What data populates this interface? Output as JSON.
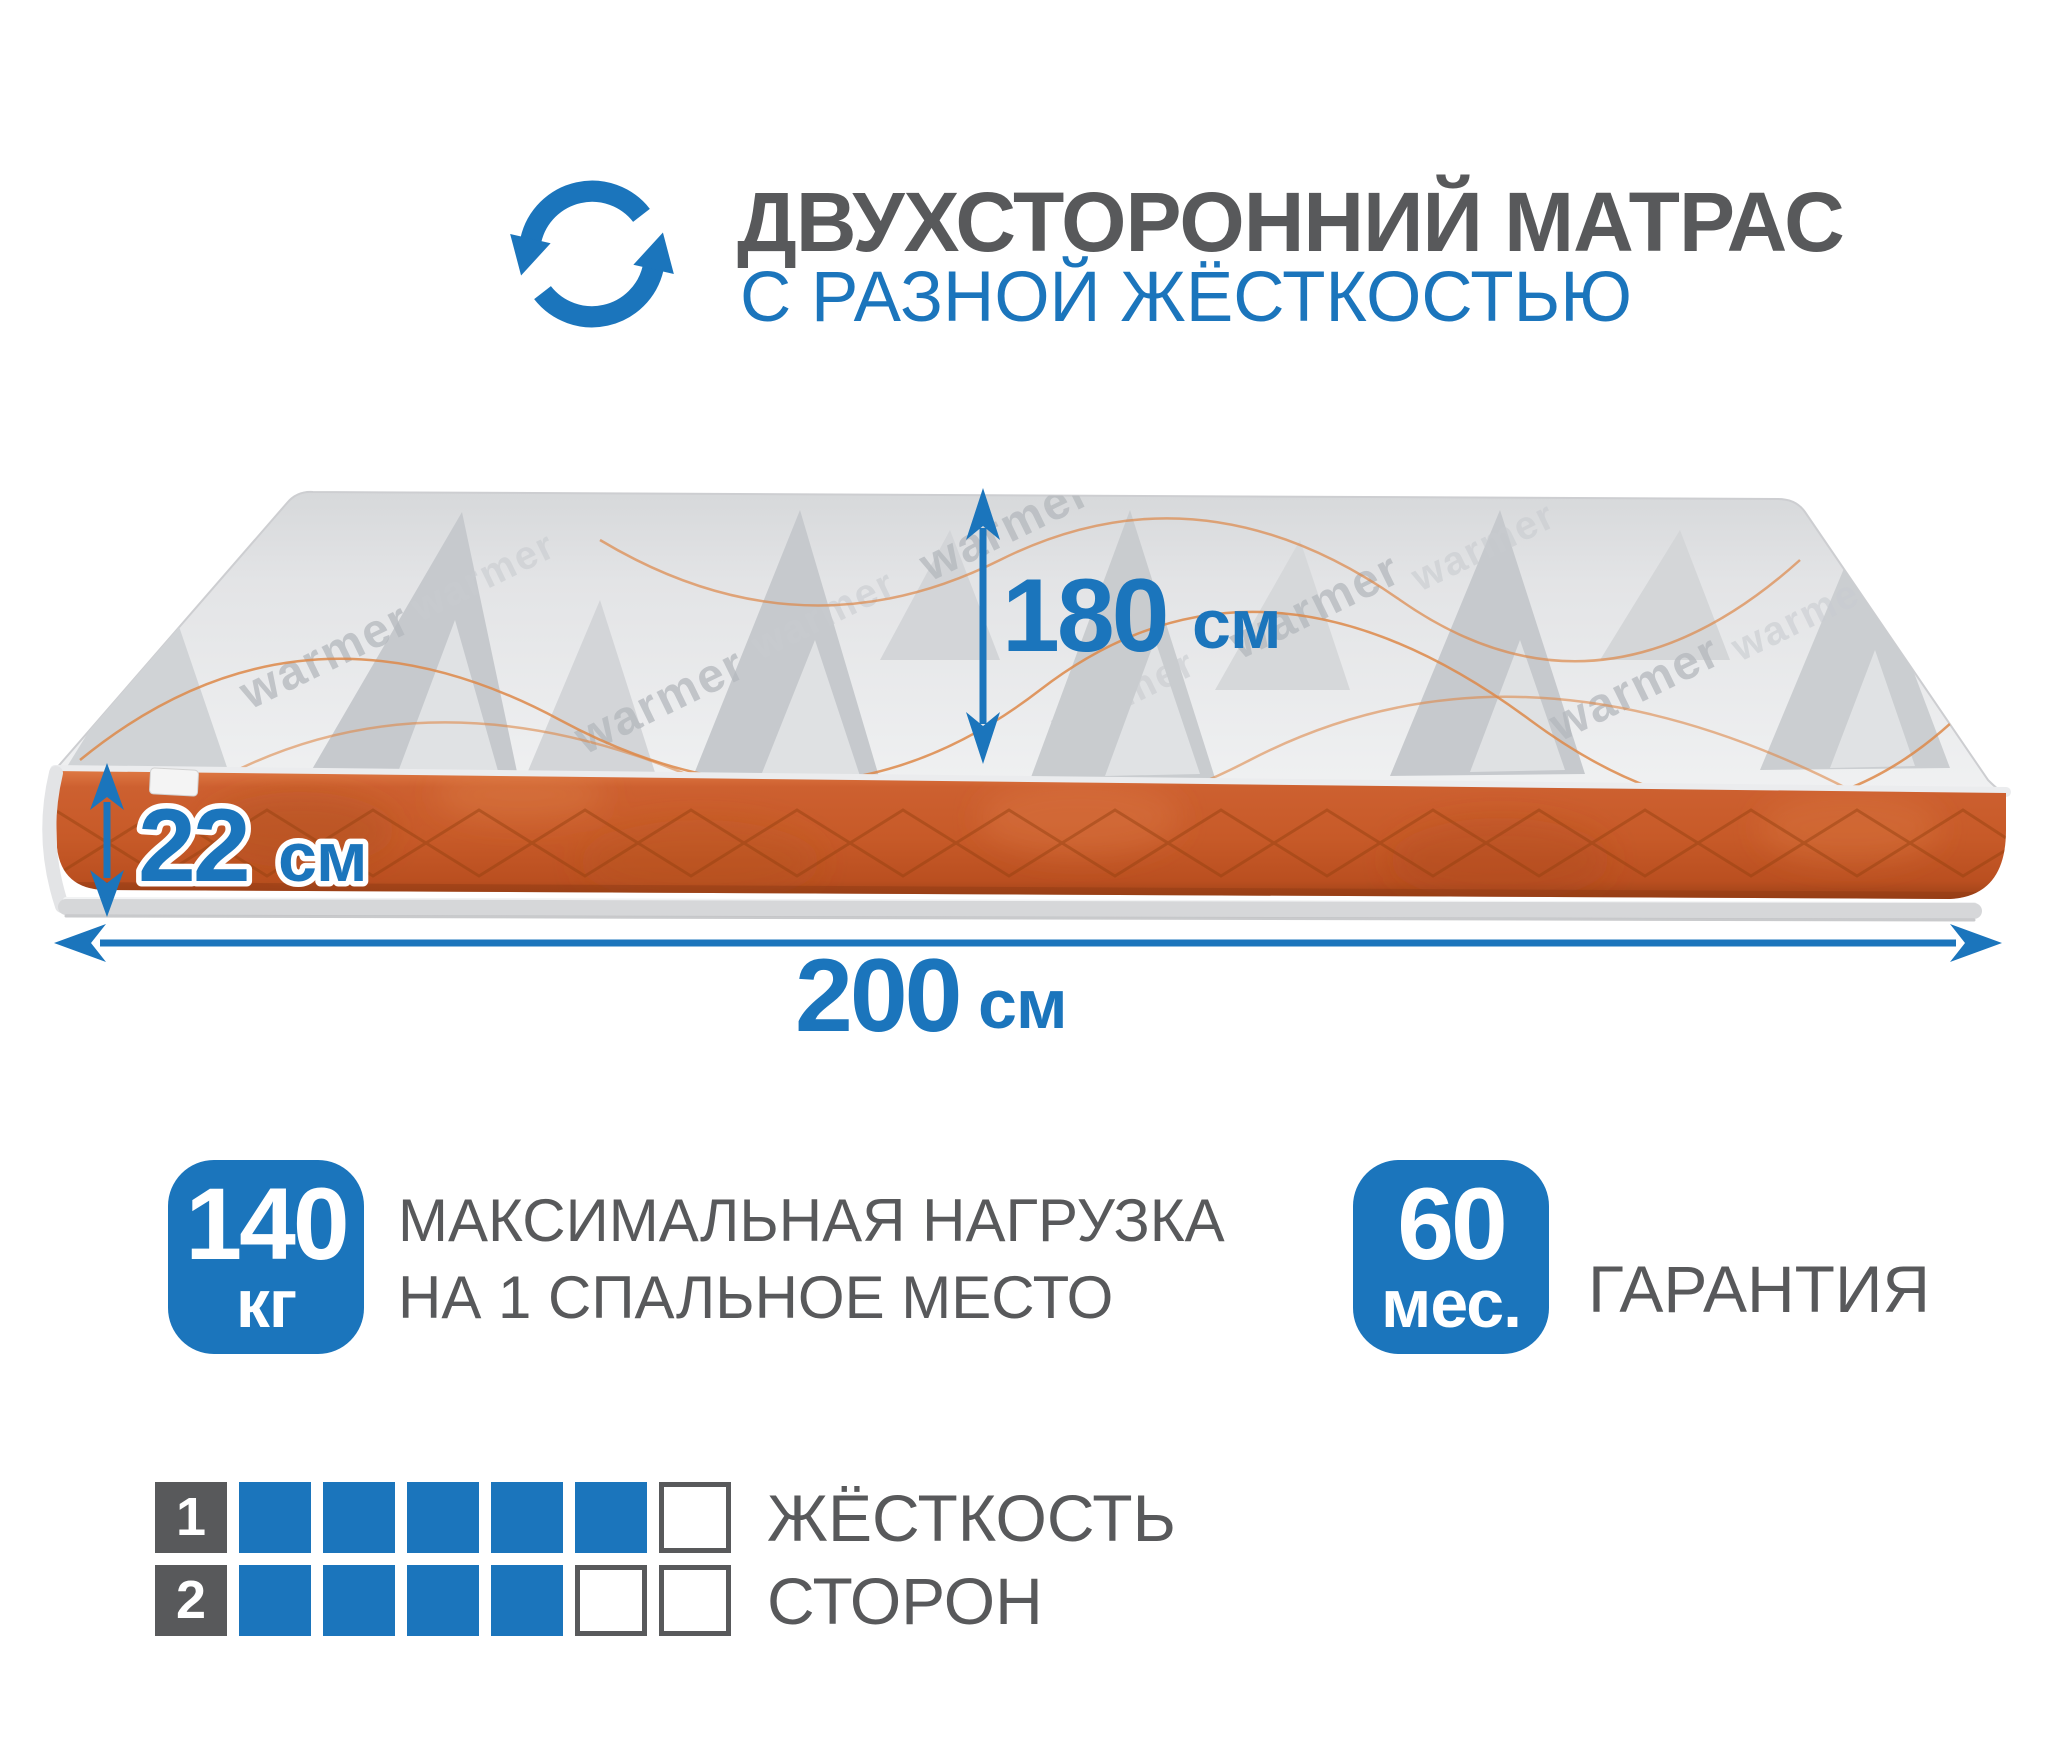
{
  "header": {
    "title": "ДВУХСТОРОННИЙ МАТРАС",
    "subtitle": "С РАЗНОЙ ЖЁСТКОСТЬЮ"
  },
  "mattress": {
    "fabric_brand": "warmer",
    "dimensions": {
      "length": {
        "value": "180",
        "unit": "см"
      },
      "height": {
        "value": "22",
        "unit": "см"
      },
      "width": {
        "value": "200",
        "unit": "см"
      }
    }
  },
  "features": {
    "max_load": {
      "value": "140",
      "unit": "кг",
      "label_line1": "МАКСИМАЛЬНАЯ НАГРУЗКА",
      "label_line2": "НА 1 СПАЛЬНОЕ МЕСТО"
    },
    "warranty": {
      "value": "60",
      "unit": "мес.",
      "label": "ГАРАНТИЯ"
    }
  },
  "firmness": {
    "title_line1": "ЖЁСТКОСТЬ",
    "title_line2": "СТОРОН",
    "scale_max": 6,
    "sides": [
      {
        "index": "1",
        "value": 5
      },
      {
        "index": "2",
        "value": 4
      }
    ]
  },
  "colors": {
    "accent_blue": "#1b75bc",
    "text_gray": "#58595b",
    "mattress_orange": "#c75d2e",
    "mattress_top_gray": "#e7e8ea"
  }
}
